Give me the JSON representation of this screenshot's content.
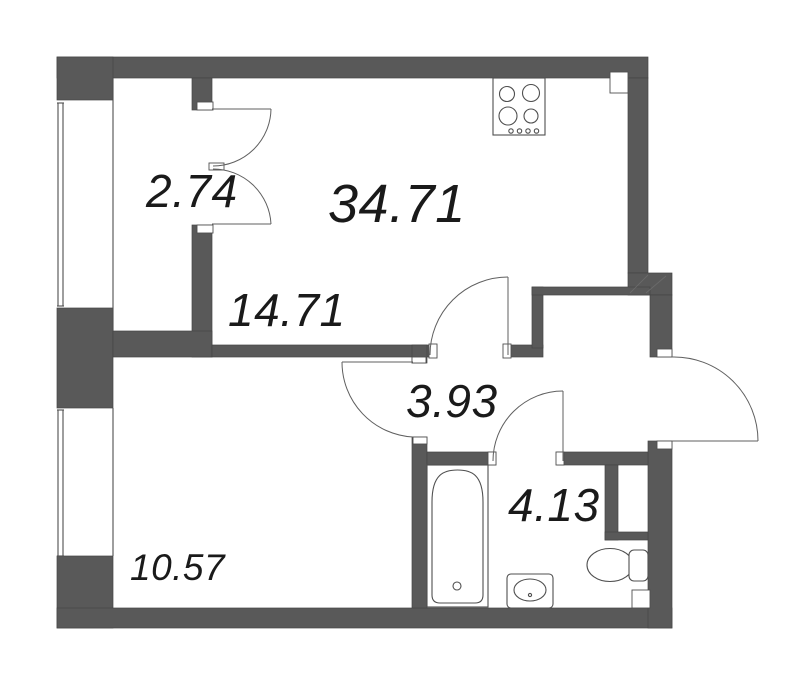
{
  "plan": {
    "kind": "apartment-floor-plan",
    "colors": {
      "wall": "#595959",
      "line": "#4f4f4f",
      "text": "#1a1a1a",
      "background": "#ffffff"
    },
    "labels": {
      "total_area": "34.71",
      "closet_area": "2.74",
      "living_area": "14.71",
      "hall_area": "3.93",
      "bathroom_area": "4.13",
      "bedroom_area": "10.57"
    },
    "icons": [
      "stove-icon",
      "bathtub-icon",
      "sink-icon",
      "toilet-icon",
      "door-swing-arc",
      "window-glazing"
    ]
  }
}
